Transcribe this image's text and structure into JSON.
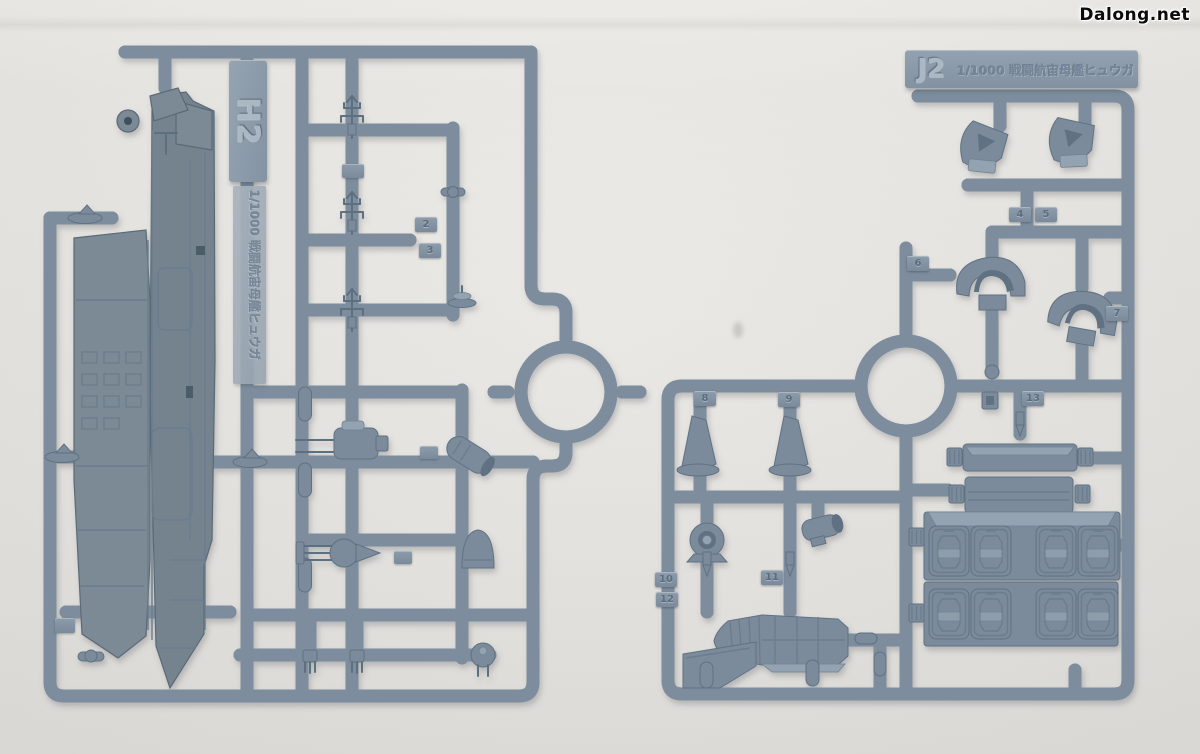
{
  "watermark": {
    "text": "Dalong.net"
  },
  "scene": {
    "description": "Two blue-gray injection-molded plastic model sprues on a white table",
    "background_color": "#e9e7e3",
    "plastic_runner_color": "#7d8d9d",
    "plastic_highlight_color": "#9fafbc",
    "part_color": "#7b8b9b"
  },
  "left_sprue": {
    "code": "H2",
    "scale_label": "1/1000 戦闘航宙母艦ヒュウガ",
    "part_numbers": [
      "2",
      "3"
    ]
  },
  "right_sprue": {
    "code": "J2",
    "scale_label": "1/1000 戦闘航宙母艦ヒュウガ",
    "part_numbers": [
      "4",
      "5",
      "6",
      "7",
      "8",
      "9",
      "10",
      "11",
      "12",
      "13"
    ]
  }
}
